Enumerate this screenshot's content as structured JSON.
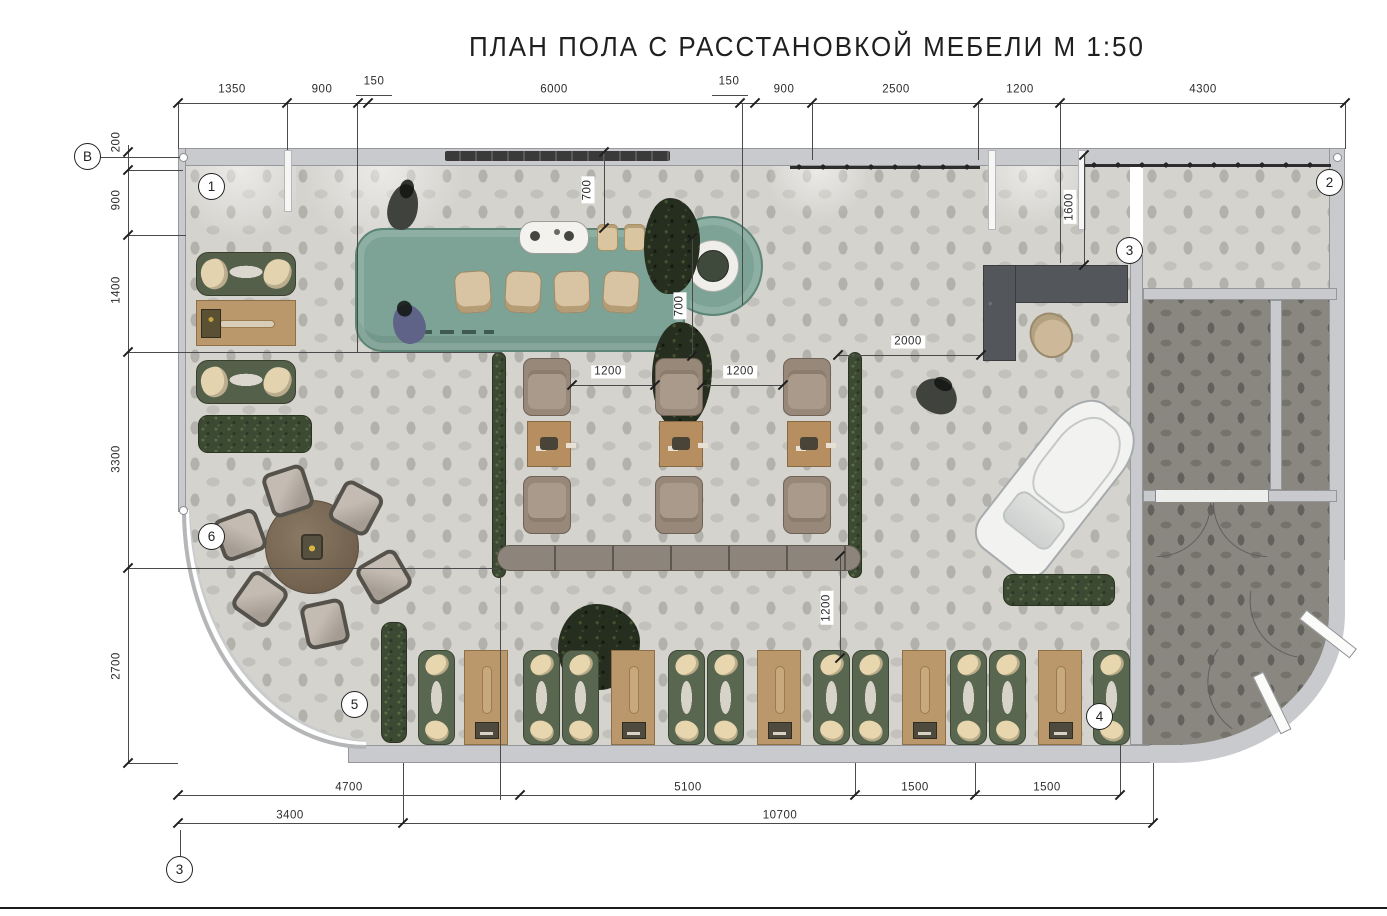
{
  "title": "ПЛАН ПОЛА С РАССТАНОВКОЙ МЕБЕЛИ  М 1:50",
  "palette": {
    "wall": "#c9cacd",
    "floor_light": "#d5d3ce",
    "floor_dark": "#898780",
    "bar_green": "#7ca396",
    "sofa_green": "#55604b",
    "wood": "#bb986c",
    "armchair": "#978879",
    "desk_dark": "#53565a",
    "hedge": "#3d4a33"
  },
  "markers": [
    {
      "t": "В",
      "x": 88,
      "y": 157
    },
    {
      "t": "1",
      "x": 212,
      "y": 187
    },
    {
      "t": "2",
      "x": 1330,
      "y": 183
    },
    {
      "t": "3",
      "x": 1130,
      "y": 251
    },
    {
      "t": "4",
      "x": 1100,
      "y": 717
    },
    {
      "t": "5",
      "x": 355,
      "y": 705
    },
    {
      "t": "6",
      "x": 212,
      "y": 537
    },
    {
      "t": "3",
      "x": 180,
      "y": 870
    }
  ],
  "dim_labels": [
    {
      "t": "1350",
      "x": 232,
      "y": 90
    },
    {
      "t": "900",
      "x": 322,
      "y": 90
    },
    {
      "t": "150",
      "x": 374,
      "y": 82
    },
    {
      "t": "6000",
      "x": 554,
      "y": 90
    },
    {
      "t": "150",
      "x": 729,
      "y": 82
    },
    {
      "t": "900",
      "x": 784,
      "y": 90
    },
    {
      "t": "2500",
      "x": 896,
      "y": 90
    },
    {
      "t": "1200",
      "x": 1020,
      "y": 90
    },
    {
      "t": "4300",
      "x": 1203,
      "y": 90
    },
    {
      "t": "200",
      "x": 117,
      "y": 142,
      "v": true
    },
    {
      "t": "900",
      "x": 117,
      "y": 200,
      "v": true
    },
    {
      "t": "1400",
      "x": 117,
      "y": 290,
      "v": true
    },
    {
      "t": "3300",
      "x": 117,
      "y": 459,
      "v": true
    },
    {
      "t": "2700",
      "x": 117,
      "y": 666,
      "v": true
    },
    {
      "t": "4700",
      "x": 349,
      "y": 788
    },
    {
      "t": "5100",
      "x": 688,
      "y": 788
    },
    {
      "t": "1500",
      "x": 915,
      "y": 788
    },
    {
      "t": "1500",
      "x": 1047,
      "y": 788
    },
    {
      "t": "3400",
      "x": 290,
      "y": 816
    },
    {
      "t": "10700",
      "x": 780,
      "y": 816
    },
    {
      "t": "1200",
      "x": 608,
      "y": 372
    },
    {
      "t": "1200",
      "x": 740,
      "y": 372
    },
    {
      "t": "2000",
      "x": 908,
      "y": 342
    },
    {
      "t": "700",
      "x": 588,
      "y": 190,
      "v": true
    },
    {
      "t": "700",
      "x": 680,
      "y": 306,
      "v": true
    },
    {
      "t": "1600",
      "x": 1070,
      "y": 207,
      "v": true
    },
    {
      "t": "1200",
      "x": 827,
      "y": 608,
      "v": true
    }
  ],
  "lines": [
    {
      "n": "dim-chain-top",
      "x": 178,
      "y": 103,
      "w": 1167,
      "h": 1
    },
    {
      "n": "dim-chain-left",
      "x": 128,
      "y": 145,
      "w": 1,
      "h": 618
    },
    {
      "n": "dim-chain-bottom-1",
      "x": 178,
      "y": 795,
      "w": 942,
      "h": 1
    },
    {
      "n": "dim-chain-bottom-2",
      "x": 178,
      "y": 823,
      "w": 975,
      "h": 1
    },
    {
      "n": "leader-150-left",
      "x": 356,
      "y": 95,
      "w": 36,
      "h": 1
    },
    {
      "n": "leader-150-right",
      "x": 712,
      "y": 95,
      "w": 36,
      "h": 1
    },
    {
      "n": "ext-top-left-end",
      "x": 178,
      "y": 103,
      "w": 1,
      "h": 46
    },
    {
      "n": "ext-top-right-end",
      "x": 1345,
      "y": 103,
      "w": 1,
      "h": 46
    },
    {
      "n": "ext-287",
      "x": 287,
      "y": 103,
      "w": 1,
      "h": 47
    },
    {
      "n": "ext-357",
      "x": 357,
      "y": 103,
      "w": 1,
      "h": 250
    },
    {
      "n": "ext-742",
      "x": 742,
      "y": 103,
      "w": 1,
      "h": 202
    },
    {
      "n": "ext-812",
      "x": 812,
      "y": 103,
      "w": 1,
      "h": 57
    },
    {
      "n": "ext-978",
      "x": 978,
      "y": 103,
      "w": 1,
      "h": 57
    },
    {
      "n": "ext-1060",
      "x": 1060,
      "y": 103,
      "w": 1,
      "h": 160
    },
    {
      "n": "leader-B",
      "x": 100,
      "y": 157,
      "w": 80,
      "h": 1
    },
    {
      "n": "ext-left-170",
      "x": 128,
      "y": 170,
      "w": 55,
      "h": 1
    },
    {
      "n": "ext-left-235",
      "x": 128,
      "y": 235,
      "w": 58,
      "h": 1
    },
    {
      "n": "ext-left-352",
      "x": 128,
      "y": 352,
      "w": 374,
      "h": 1
    },
    {
      "n": "ext-left-568",
      "x": 128,
      "y": 568,
      "w": 370,
      "h": 1
    },
    {
      "n": "ext-left-763",
      "x": 128,
      "y": 763,
      "w": 50,
      "h": 1
    },
    {
      "n": "ext-bot-403",
      "x": 403,
      "y": 763,
      "w": 1,
      "h": 60
    },
    {
      "n": "ext-bot-500",
      "x": 500,
      "y": 575,
      "w": 1,
      "h": 225
    },
    {
      "n": "ext-bot-855",
      "x": 855,
      "y": 763,
      "w": 1,
      "h": 32
    },
    {
      "n": "ext-bot-975",
      "x": 975,
      "y": 763,
      "w": 1,
      "h": 32
    },
    {
      "n": "ext-bot-1120",
      "x": 1120,
      "y": 745,
      "w": 1,
      "h": 50
    },
    {
      "n": "ext-bot-1153",
      "x": 1153,
      "y": 763,
      "w": 1,
      "h": 60
    },
    {
      "n": "leader-axis3",
      "x": 180,
      "y": 830,
      "w": 1,
      "h": 26
    },
    {
      "n": "dim-1200-a",
      "x": 572,
      "y": 385,
      "w": 83,
      "h": 1
    },
    {
      "n": "dim-1200-b",
      "x": 702,
      "y": 385,
      "w": 81,
      "h": 1
    },
    {
      "n": "dim-2000",
      "x": 838,
      "y": 355,
      "w": 143,
      "h": 1
    },
    {
      "n": "dim-700-a",
      "x": 604,
      "y": 152,
      "w": 1,
      "h": 76
    },
    {
      "n": "dim-700-b",
      "x": 692,
      "y": 238,
      "w": 1,
      "h": 118
    },
    {
      "n": "dim-1600",
      "x": 1084,
      "y": 155,
      "w": 1,
      "h": 110
    },
    {
      "n": "dim-1200-v",
      "x": 840,
      "y": 556,
      "w": 1,
      "h": 102
    }
  ],
  "ticks": [
    {
      "x": 178,
      "y": 103
    },
    {
      "x": 287,
      "y": 103
    },
    {
      "x": 358,
      "y": 103
    },
    {
      "x": 368,
      "y": 103
    },
    {
      "x": 740,
      "y": 103
    },
    {
      "x": 755,
      "y": 103
    },
    {
      "x": 812,
      "y": 103
    },
    {
      "x": 978,
      "y": 103
    },
    {
      "x": 1060,
      "y": 103
    },
    {
      "x": 1345,
      "y": 103
    },
    {
      "x": 128,
      "y": 152
    },
    {
      "x": 128,
      "y": 170
    },
    {
      "x": 128,
      "y": 235
    },
    {
      "x": 128,
      "y": 352
    },
    {
      "x": 128,
      "y": 568
    },
    {
      "x": 128,
      "y": 763
    },
    {
      "x": 178,
      "y": 795
    },
    {
      "x": 520,
      "y": 795
    },
    {
      "x": 855,
      "y": 795
    },
    {
      "x": 975,
      "y": 795
    },
    {
      "x": 1120,
      "y": 795
    },
    {
      "x": 178,
      "y": 823
    },
    {
      "x": 403,
      "y": 823
    },
    {
      "x": 1153,
      "y": 823
    },
    {
      "x": 572,
      "y": 385
    },
    {
      "x": 655,
      "y": 385
    },
    {
      "x": 702,
      "y": 385
    },
    {
      "x": 783,
      "y": 385
    },
    {
      "x": 838,
      "y": 355
    },
    {
      "x": 981,
      "y": 355
    },
    {
      "x": 604,
      "y": 152
    },
    {
      "x": 604,
      "y": 228
    },
    {
      "x": 692,
      "y": 238
    },
    {
      "x": 692,
      "y": 356
    },
    {
      "x": 1084,
      "y": 155
    },
    {
      "x": 1084,
      "y": 265
    },
    {
      "x": 840,
      "y": 556
    },
    {
      "x": 840,
      "y": 658
    }
  ],
  "items": [
    {
      "n": "entry-light-1",
      "t": "light-fan",
      "x": 186,
      "y": 166,
      "w": 110,
      "h": 85
    },
    {
      "n": "entry-light-2",
      "t": "light-fan",
      "x": 300,
      "y": 166,
      "w": 165,
      "h": 80
    },
    {
      "n": "entry-light-3",
      "t": "light-fan",
      "x": 770,
      "y": 166,
      "w": 95,
      "h": 60
    },
    {
      "n": "entry-light-4",
      "t": "light-fan",
      "x": 985,
      "y": 166,
      "w": 95,
      "h": 70
    },
    {
      "n": "wall-pier-1",
      "t": "pier",
      "x": 284,
      "y": 150,
      "w": 8,
      "h": 62
    },
    {
      "n": "wall-pier-2",
      "t": "pier",
      "x": 988,
      "y": 150,
      "w": 8,
      "h": 80
    },
    {
      "n": "wall-pier-3",
      "t": "pier",
      "x": 1078,
      "y": 150,
      "w": 8,
      "h": 80
    },
    {
      "n": "wall-shelf",
      "t": "shelf",
      "x": 445,
      "y": 151,
      "w": 225,
      "h": 10
    },
    {
      "n": "clothes-rack-1",
      "t": "rack",
      "x": 790,
      "y": 158,
      "w": 190,
      "h": 18
    },
    {
      "n": "clothes-rack-2",
      "t": "rack",
      "x": 1085,
      "y": 156,
      "w": 246,
      "h": 18
    },
    {
      "n": "manicure-sofa-1",
      "t": "sofa-green-h",
      "x": 196,
      "y": 252,
      "w": 100,
      "h": 44
    },
    {
      "n": "manicure-table",
      "t": "wood-table-h",
      "x": 196,
      "y": 300,
      "w": 100,
      "h": 46
    },
    {
      "n": "manicure-sofa-2",
      "t": "sofa-green-h",
      "x": 196,
      "y": 360,
      "w": 100,
      "h": 44
    },
    {
      "n": "hedge-left",
      "t": "hedge-h",
      "x": 198,
      "y": 415,
      "w": 114,
      "h": 38
    },
    {
      "n": "bar-counter",
      "t": "bar-slab",
      "x": 355,
      "y": 228,
      "w": 330,
      "h": 124
    },
    {
      "n": "bar-round-end",
      "t": "bar-circle",
      "x": 663,
      "y": 216,
      "w": 100,
      "h": 100
    },
    {
      "n": "bar-bridge",
      "t": "bar-bridge",
      "x": 650,
      "y": 242,
      "w": 40,
      "h": 66
    },
    {
      "n": "bar-basin",
      "t": "basin",
      "x": 688,
      "y": 241,
      "w": 50,
      "h": 50
    },
    {
      "n": "coffee-machine",
      "t": "coffee-machine",
      "x": 519,
      "y": 221,
      "w": 70,
      "h": 33
    },
    {
      "n": "bar-cup-1",
      "t": "cup",
      "x": 597,
      "y": 224,
      "w": 21,
      "h": 27
    },
    {
      "n": "bar-cup-2",
      "t": "cup",
      "x": 624,
      "y": 224,
      "w": 21,
      "h": 27
    },
    {
      "n": "bar-plant-1",
      "t": "plant-blob",
      "x": 644,
      "y": 198,
      "w": 56,
      "h": 96
    },
    {
      "n": "bar-plant-2",
      "t": "plant-blob",
      "x": 652,
      "y": 322,
      "w": 60,
      "h": 106
    },
    {
      "n": "bar-stool-1",
      "t": "stool",
      "x": 455,
      "y": 271,
      "w": 36,
      "h": 42,
      "r": -4
    },
    {
      "n": "bar-stool-2",
      "t": "stool",
      "x": 505,
      "y": 271,
      "w": 36,
      "h": 42,
      "r": 3
    },
    {
      "n": "bar-stool-3",
      "t": "stool",
      "x": 554,
      "y": 271,
      "w": 36,
      "h": 42,
      "r": -2
    },
    {
      "n": "bar-stool-4",
      "t": "stool",
      "x": 603,
      "y": 271,
      "w": 36,
      "h": 42,
      "r": 4
    },
    {
      "n": "person-barista",
      "t": "person-dark",
      "x": 388,
      "y": 184,
      "w": 30,
      "h": 46,
      "r": 12
    },
    {
      "n": "person-guest",
      "t": "person-blue",
      "x": 393,
      "y": 304,
      "w": 32,
      "h": 40,
      "r": -18
    },
    {
      "n": "round-table",
      "t": "round-table",
      "x": 265,
      "y": 500,
      "w": 94,
      "h": 94
    },
    {
      "n": "chair-1",
      "t": "chair-sq",
      "x": 266,
      "y": 468,
      "w": 44,
      "h": 46,
      "r": -18
    },
    {
      "n": "chair-2",
      "t": "chair-sq",
      "x": 334,
      "y": 485,
      "w": 44,
      "h": 46,
      "r": 28
    },
    {
      "n": "chair-3",
      "t": "chair-sq",
      "x": 218,
      "y": 512,
      "w": 44,
      "h": 46,
      "r": 70
    },
    {
      "n": "chair-4",
      "t": "chair-sq",
      "x": 362,
      "y": 554,
      "w": 44,
      "h": 46,
      "r": 60
    },
    {
      "n": "chair-5",
      "t": "chair-sq",
      "x": 238,
      "y": 576,
      "w": 44,
      "h": 46,
      "r": 35
    },
    {
      "n": "chair-6",
      "t": "chair-sq",
      "x": 303,
      "y": 601,
      "w": 44,
      "h": 46,
      "r": -12
    },
    {
      "n": "hedge-center-left",
      "t": "hedge-v",
      "x": 492,
      "y": 352,
      "w": 14,
      "h": 226
    },
    {
      "n": "hedge-center-right",
      "t": "hedge-v",
      "x": 848,
      "y": 352,
      "w": 14,
      "h": 226
    },
    {
      "n": "bench-long",
      "t": "bench",
      "x": 497,
      "y": 545,
      "w": 364,
      "h": 26
    },
    {
      "n": "armchair-1a",
      "t": "armchair",
      "x": 523,
      "y": 358,
      "w": 48,
      "h": 58
    },
    {
      "n": "armchair-1b",
      "t": "armchair",
      "x": 523,
      "y": 476,
      "w": 48,
      "h": 58,
      "r": 180
    },
    {
      "n": "armchair-2a",
      "t": "armchair",
      "x": 655,
      "y": 358,
      "w": 48,
      "h": 58
    },
    {
      "n": "armchair-2b",
      "t": "armchair",
      "x": 655,
      "y": 476,
      "w": 48,
      "h": 58,
      "r": 180
    },
    {
      "n": "armchair-3a",
      "t": "armchair",
      "x": 783,
      "y": 358,
      "w": 48,
      "h": 58
    },
    {
      "n": "armchair-3b",
      "t": "armchair",
      "x": 783,
      "y": 476,
      "w": 48,
      "h": 58,
      "r": 180
    },
    {
      "n": "coffee-table-1",
      "t": "coffee-table",
      "x": 527,
      "y": 421,
      "w": 44,
      "h": 46
    },
    {
      "n": "coffee-table-2",
      "t": "coffee-table",
      "x": 659,
      "y": 421,
      "w": 44,
      "h": 46
    },
    {
      "n": "coffee-table-3",
      "t": "coffee-table",
      "x": 787,
      "y": 421,
      "w": 44,
      "h": 46
    },
    {
      "n": "person-sitting",
      "t": "person-dark",
      "x": 916,
      "y": 379,
      "w": 42,
      "h": 34,
      "r": 25
    },
    {
      "n": "reception-desk-top",
      "t": "desk",
      "x": 983,
      "y": 265,
      "w": 145,
      "h": 38
    },
    {
      "n": "reception-desk-side",
      "t": "desk",
      "x": 983,
      "y": 265,
      "w": 33,
      "h": 96
    },
    {
      "n": "reception-chair",
      "t": "office-chair",
      "x": 1030,
      "y": 312,
      "w": 42,
      "h": 46,
      "r": -30
    },
    {
      "n": "display-car",
      "t": "car",
      "x": 1015,
      "y": 392,
      "w": 85,
      "h": 190,
      "r": 38
    },
    {
      "n": "hedge-car",
      "t": "hedge-h",
      "x": 1003,
      "y": 574,
      "w": 112,
      "h": 32
    },
    {
      "n": "hedge-bottom-left",
      "t": "hedge-v",
      "x": 381,
      "y": 622,
      "w": 26,
      "h": 121
    },
    {
      "n": "plant-mid",
      "t": "plant-blob",
      "x": 558,
      "y": 604,
      "w": 82,
      "h": 86
    },
    {
      "n": "pedicure-lounger-1",
      "t": "lounger",
      "x": 418,
      "y": 650,
      "w": 37,
      "h": 95
    },
    {
      "n": "pedicure-table-1",
      "t": "wood-table-v",
      "x": 464,
      "y": 650,
      "w": 44,
      "h": 95
    },
    {
      "n": "pedicure-lounger-2",
      "t": "lounger",
      "x": 523,
      "y": 650,
      "w": 37,
      "h": 95
    },
    {
      "n": "pedicure-lounger-3",
      "t": "lounger",
      "x": 562,
      "y": 650,
      "w": 37,
      "h": 95
    },
    {
      "n": "pedicure-table-2",
      "t": "wood-table-v",
      "x": 611,
      "y": 650,
      "w": 44,
      "h": 95
    },
    {
      "n": "pedicure-lounger-4",
      "t": "lounger",
      "x": 668,
      "y": 650,
      "w": 37,
      "h": 95
    },
    {
      "n": "pedicure-lounger-5",
      "t": "lounger",
      "x": 707,
      "y": 650,
      "w": 37,
      "h": 95
    },
    {
      "n": "pedicure-table-3",
      "t": "wood-table-v",
      "x": 757,
      "y": 650,
      "w": 44,
      "h": 95
    },
    {
      "n": "pedicure-lounger-6",
      "t": "lounger",
      "x": 813,
      "y": 650,
      "w": 37,
      "h": 95
    },
    {
      "n": "pedicure-lounger-7",
      "t": "lounger",
      "x": 852,
      "y": 650,
      "w": 37,
      "h": 95
    },
    {
      "n": "pedicure-table-4",
      "t": "wood-table-v",
      "x": 902,
      "y": 650,
      "w": 44,
      "h": 95
    },
    {
      "n": "pedicure-lounger-8",
      "t": "lounger",
      "x": 950,
      "y": 650,
      "w": 37,
      "h": 95
    },
    {
      "n": "pedicure-lounger-9",
      "t": "lounger",
      "x": 989,
      "y": 650,
      "w": 37,
      "h": 95
    },
    {
      "n": "pedicure-table-5",
      "t": "wood-table-v",
      "x": 1038,
      "y": 650,
      "w": 44,
      "h": 95
    },
    {
      "n": "pedicure-lounger-10",
      "t": "lounger",
      "x": 1093,
      "y": 650,
      "w": 37,
      "h": 95
    },
    {
      "n": "door-gap-fitting",
      "t": "door-gap",
      "x": 1155,
      "y": 490,
      "w": 114,
      "h": 12
    },
    {
      "n": "door-swing-left",
      "t": "swing-r",
      "x": 1157,
      "y": 503,
      "w": 54,
      "h": 54
    },
    {
      "n": "door-swing-right",
      "t": "swing-l",
      "x": 1213,
      "y": 503,
      "w": 54,
      "h": 54
    },
    {
      "n": "exit-door-1",
      "t": "door-leaf",
      "x": 1296,
      "y": 628,
      "w": 64,
      "h": 12,
      "r": 38
    },
    {
      "n": "exit-door-2",
      "t": "door-leaf",
      "x": 1240,
      "y": 697,
      "w": 64,
      "h": 12,
      "r": 64
    },
    {
      "n": "exit-swing-1",
      "t": "swing-l",
      "x": 1245,
      "y": 595,
      "w": 58,
      "h": 58,
      "r": 10
    },
    {
      "n": "exit-swing-2",
      "t": "swing-l",
      "x": 1196,
      "y": 660,
      "w": 58,
      "h": 58,
      "r": 35
    }
  ]
}
